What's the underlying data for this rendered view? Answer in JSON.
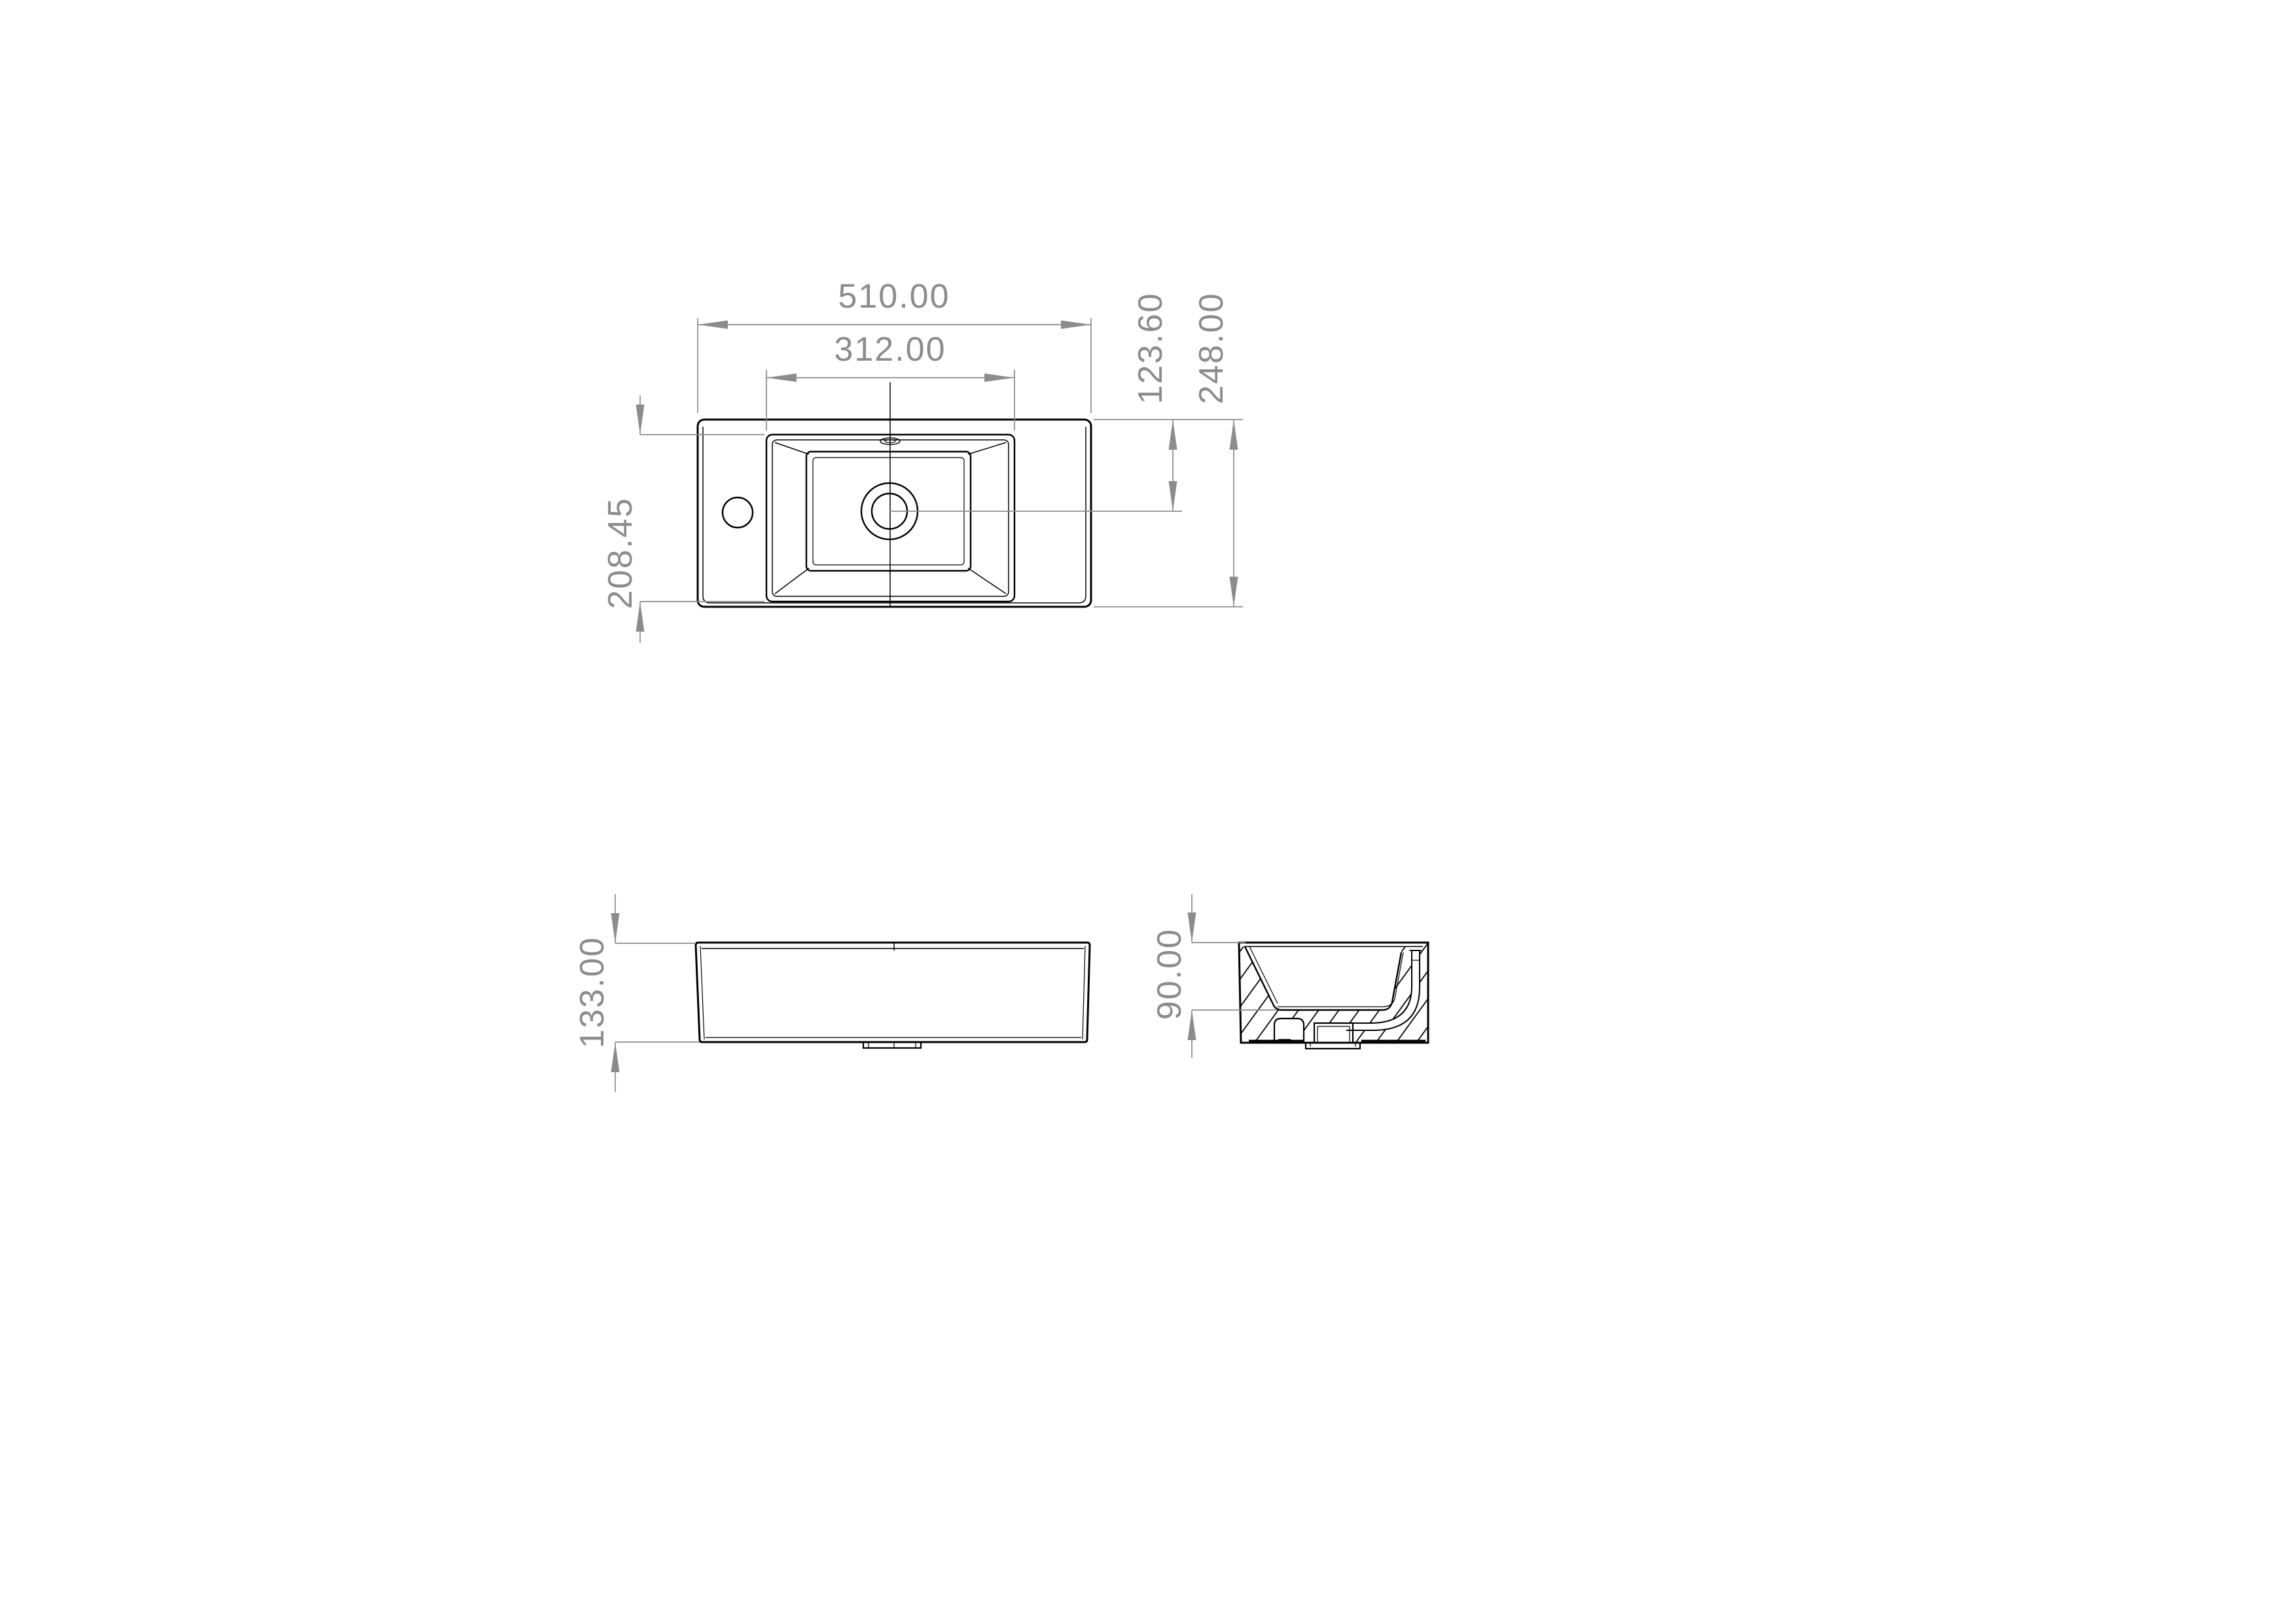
{
  "document": {
    "type": "technical-drawing-sink",
    "background": "#ffffff",
    "geometry_color": "#000000",
    "dimension_color": "#8c8c8c"
  },
  "dimensions": {
    "overall_width": "510.00",
    "basin_width": "312.00",
    "drain_center_from_back": "123.60",
    "overall_depth": "248.00",
    "basin_depth": "208.45",
    "overall_height": "133.00",
    "basin_inner_depth": "90.00"
  }
}
